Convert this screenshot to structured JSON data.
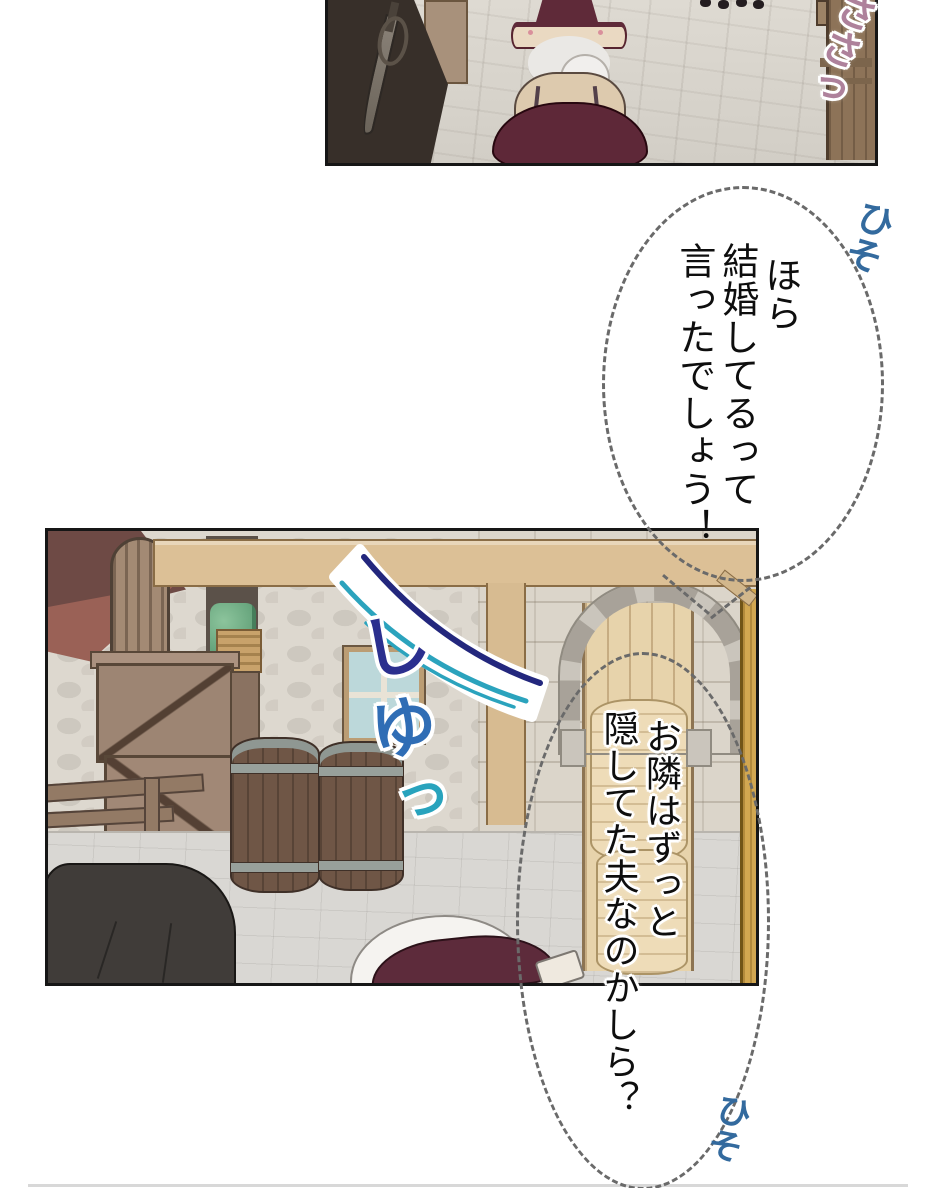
{
  "bubbles": {
    "whisper1": {
      "lines": [
        "ほら",
        "結婚してるって",
        "言ったでしょう！"
      ]
    },
    "whisper2": {
      "lines": [
        "お隣はずっと",
        "隠してた夫なのかしら？"
      ]
    }
  },
  "sfx": {
    "sasa": {
      "text": "ささっ",
      "color": "#ae819b"
    },
    "hiso_top": {
      "text": "ひそ",
      "color": "#336a9e"
    },
    "hiso_bottom": {
      "text": "ひそ",
      "color": "#336a9e"
    },
    "shu_chars": [
      {
        "ch": "し",
        "color": "#2b2f8e"
      },
      {
        "ch": "ゆ",
        "color": "#2f6db5"
      },
      {
        "ch": "っ",
        "color": "#28a3bd"
      }
    ]
  },
  "colors": {
    "bubble_dash": "#6a6a6a",
    "maroon_outfit": "#5e2838",
    "swoosh_navy": "#23277d",
    "swoosh_teal": "#2ba3bd"
  }
}
